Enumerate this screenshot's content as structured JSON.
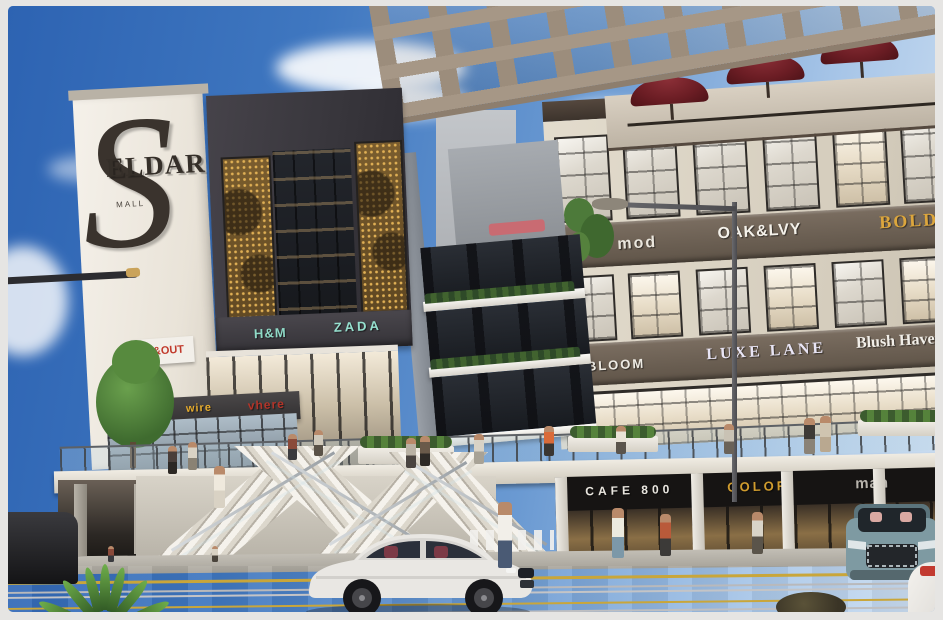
{
  "logo": {
    "monogram": "S",
    "text": "ELDAR",
    "subtext": "MALL"
  },
  "signs": {
    "left_upper": [
      {
        "label": "H&M",
        "color": "#8fd9c6"
      },
      {
        "label": "ZADA",
        "color": "#96e0cf"
      }
    ],
    "inout": {
      "label": "IN&OUT",
      "color": "#c1392b"
    },
    "left_lower": [
      {
        "label": "BETAMRT",
        "color": "#efece6"
      },
      {
        "label": "wire",
        "color": "#e4ab2e"
      },
      {
        "label": "vhere",
        "color": "#b23429"
      }
    ],
    "right_upper": [
      {
        "label": "man mod",
        "color": "#eae6dd"
      },
      {
        "label": "OAK&LVY",
        "color": "#f4f1ea"
      },
      {
        "label": "BOLD",
        "color": "#dca63d"
      }
    ],
    "right_mid": [
      {
        "label": "BLOOM",
        "color": "#eeebe4"
      },
      {
        "label": "LUXE LANE",
        "color": "#e9e5f5"
      },
      {
        "label": "Blush Haven",
        "color": "#f1eee8"
      }
    ],
    "right_ground": [
      {
        "label": "CAFE 800",
        "color": "#e9e6df"
      },
      {
        "label": "COLOR",
        "color": "#d09c2e"
      },
      {
        "label": "man",
        "color": "#b7b3ac"
      }
    ]
  },
  "palette": {
    "sky_top": "#2d63b2",
    "facade_beige": "#d9d2c3",
    "fascia_brown": "#6e6156",
    "dark_tower": "#38363c",
    "gold_panel": "#7a5d2e",
    "umbrella_red": "#6b1d24",
    "sedan_body": "#e9e7e3",
    "suv_body": "#7e9aa2"
  }
}
